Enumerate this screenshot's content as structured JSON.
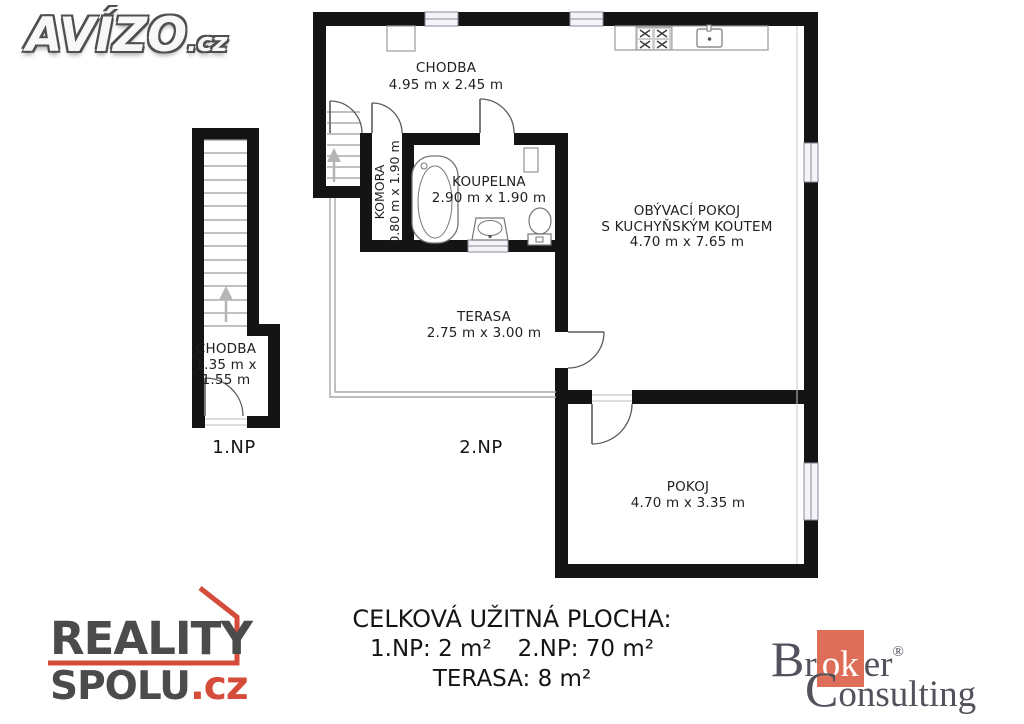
{
  "avizo_logo": {
    "text": "AVÍZO",
    "tld": ".cz"
  },
  "floor_plan": {
    "rooms": [
      {
        "name": "CHODBA",
        "dims": "4.95 m x 2.45 m"
      },
      {
        "name": "KOMORA",
        "dims": "0.80 m x 1.90 m"
      },
      {
        "name": "KOUPELNA",
        "dims": "2.90 m x 1.90 m"
      },
      {
        "name": "OBÝVACÍ POKOJ",
        "name_line2": "S KUCHYŇSKÝM KOUTEM",
        "dims": "4.70 m x 7.65 m"
      },
      {
        "name": "TERASA",
        "dims": "2.75 m x 3.00 m"
      },
      {
        "name": "POKOJ",
        "dims": "4.70 m x 3.35 m"
      },
      {
        "name": "CHODBA",
        "dims_line1": "1.35 m x",
        "dims_line2": "1.55 m"
      }
    ],
    "floor_labels": {
      "first": "1.NP",
      "second": "2.NP"
    },
    "icons": [
      "stove-icon",
      "sink-icon",
      "bathtub-icon",
      "washbasin-icon",
      "toilet-icon",
      "wardrobe-icon",
      "shelf-icon",
      "stairs-up-arrow-icon"
    ]
  },
  "summary": {
    "title": "CELKOVÁ UŽITNÁ PLOCHA:",
    "np1": "1.NP: 2 m²",
    "np2": "2.NP: 70 m²",
    "terasa": "TERASA: 8 m²"
  },
  "reality_logo": {
    "line1": "REALITY",
    "line2": "SPOLU",
    "tld": ".cz",
    "text_color": "#4b4b4b",
    "accent_color": "#d54c3a"
  },
  "broker_logo": {
    "pre": "Br",
    "highlight": "ok",
    "post": "er",
    "registered": "®",
    "line2": "Consulting",
    "text_color": "#52525c",
    "accent_color": "#de6e58"
  },
  "colors": {
    "wall": "#141414",
    "thin_line": "#8a8a8a",
    "text": "#1f1f1f"
  }
}
